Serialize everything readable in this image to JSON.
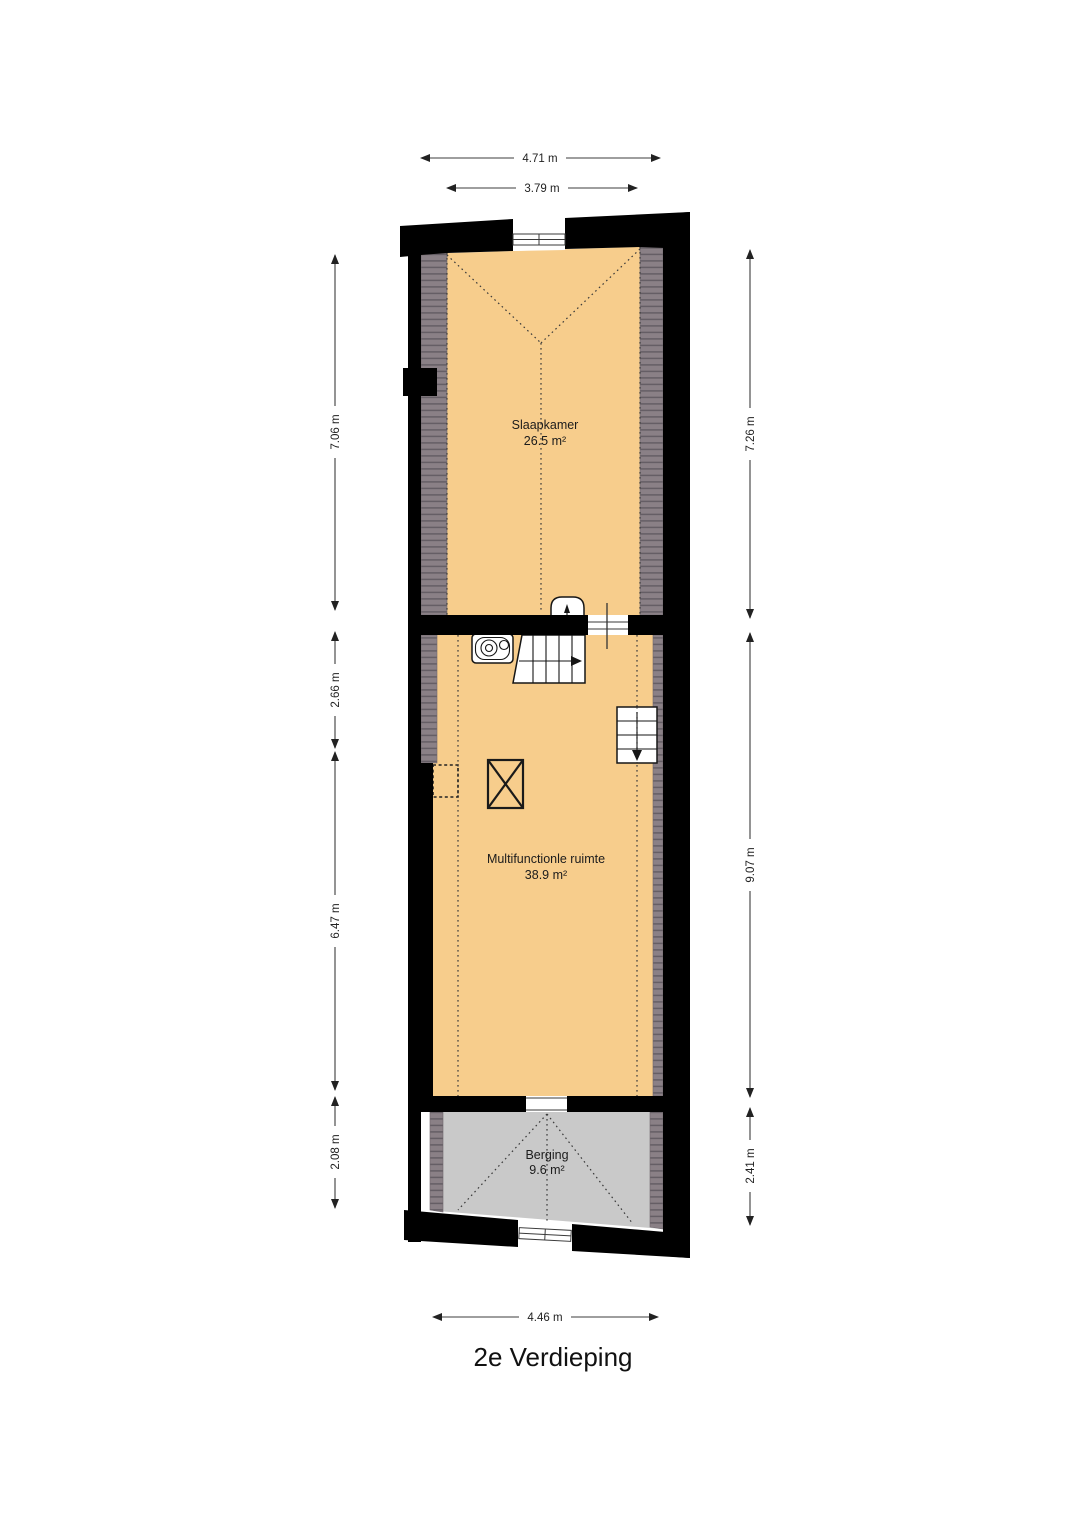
{
  "title": "2e Verdieping",
  "colors": {
    "floor": "#F7CD8C",
    "storage_floor": "#C9C9C9",
    "slope_hatch": "#8A8086",
    "slope_hatch_line": "#655E65",
    "wall": "#000000"
  },
  "rooms": [
    {
      "name": "Slaapkamer",
      "area": "26.5 m²"
    },
    {
      "name": "Multifunctionle ruimte",
      "area": "38.9 m²"
    },
    {
      "name": "Berging",
      "area": "9.6 m²"
    }
  ],
  "dimensions": {
    "top": [
      "4.71 m",
      "3.79 m"
    ],
    "bottom": [
      "4.46 m"
    ],
    "left": [
      "7.06 m",
      "2.66 m",
      "6.47 m",
      "2.08 m"
    ],
    "right": [
      "7.26 m",
      "9.07 m",
      "2.41 m"
    ]
  }
}
